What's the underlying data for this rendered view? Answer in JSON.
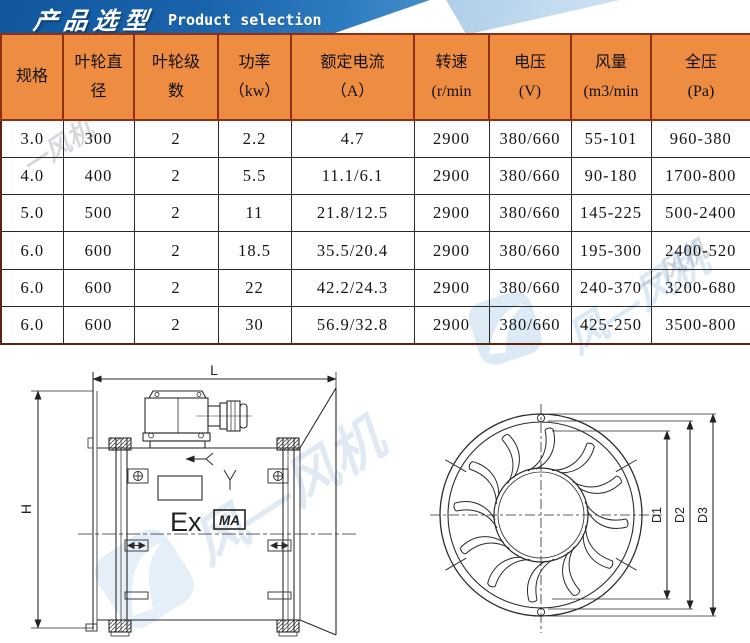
{
  "banner": {
    "title_zh": "产品选型",
    "title_en": "Product selection"
  },
  "colors": {
    "banner_blue": "#1a64ac",
    "banner_light_blue": "#a9cbe7",
    "table_header_bg": "#ee8c42",
    "table_header_border": "#8f3014",
    "table_body_border": "#2a2a2a"
  },
  "table": {
    "headers": [
      {
        "line1": "规格",
        "line2": ""
      },
      {
        "line1": "叶轮直",
        "line2": "径"
      },
      {
        "line1": "叶轮级",
        "line2": "数"
      },
      {
        "line1": "功率",
        "line2": "（kw）"
      },
      {
        "line1": "额定电流",
        "line2": "（A）"
      },
      {
        "line1": "转速",
        "line2": "(r/min"
      },
      {
        "line1": "电压",
        "line2": "(V)"
      },
      {
        "line1": "风量",
        "line2": "(m3/min"
      },
      {
        "line1": "全压",
        "line2": "(Pa)"
      }
    ],
    "rows": [
      [
        "3.0",
        "300",
        "2",
        "2.2",
        "4.7",
        "2900",
        "380/660",
        "55-101",
        "960-380"
      ],
      [
        "4.0",
        "400",
        "2",
        "5.5",
        "11.1/6.1",
        "2900",
        "380/660",
        "90-180",
        "1700-800"
      ],
      [
        "5.0",
        "500",
        "2",
        "11",
        "21.8/12.5",
        "2900",
        "380/660",
        "145-225",
        "500-2400"
      ],
      [
        "6.0",
        "600",
        "2",
        "18.5",
        "35.5/20.4",
        "2900",
        "380/660",
        "195-300",
        "2400-520"
      ],
      [
        "6.0",
        "600",
        "2",
        "22",
        "42.2/24.3",
        "2900",
        "380/660",
        "240-370",
        "3200-680"
      ],
      [
        "6.0",
        "600",
        "2",
        "30",
        "56.9/32.8",
        "2900",
        "380/660",
        "425-250",
        "3500-800"
      ]
    ]
  },
  "drawings": {
    "side_view": {
      "dim_length_label": "L",
      "dim_height_label": "H",
      "ex_marking": "Ex",
      "ma_marking": "MA"
    },
    "front_view": {
      "dim_labels": [
        "D1",
        "D2",
        "D3"
      ]
    }
  },
  "watermarks": {
    "gray_text": "一风机",
    "blue_text": "风—风机"
  }
}
